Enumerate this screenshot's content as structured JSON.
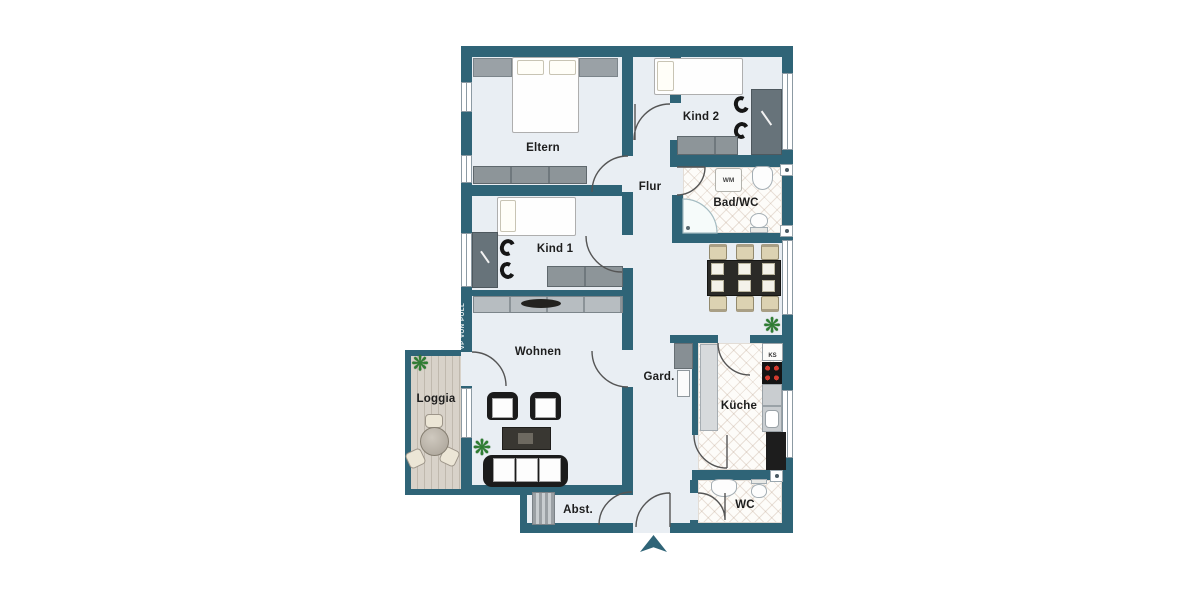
{
  "plan": {
    "type": "apartment-floorplan",
    "rooms": {
      "eltern": "Eltern",
      "kind2": "Kind 2",
      "flur": "Flur",
      "bad": "Bad/WC",
      "kind1": "Kind 1",
      "wohnen": "Wohnen",
      "gard": "Gard.",
      "kueche": "Küche",
      "loggia": "Loggia",
      "abst": "Abst.",
      "wc": "WC"
    },
    "appliances": {
      "washing_machine": "WM",
      "fridge": "KS"
    },
    "watermark": "VP VON POLL",
    "icons": {
      "entrance": "triangle-arrow-up",
      "plant": "plant-starburst"
    },
    "colors": {
      "wall": "#2f6477",
      "floor": "#e9eef3",
      "tile_line": "#cbb7a6",
      "wood_deck": "#d2ccc3",
      "plant": "#2e7d32",
      "furniture_gray": "#8d9599",
      "chair_beige": "#dcd2b2"
    }
  }
}
